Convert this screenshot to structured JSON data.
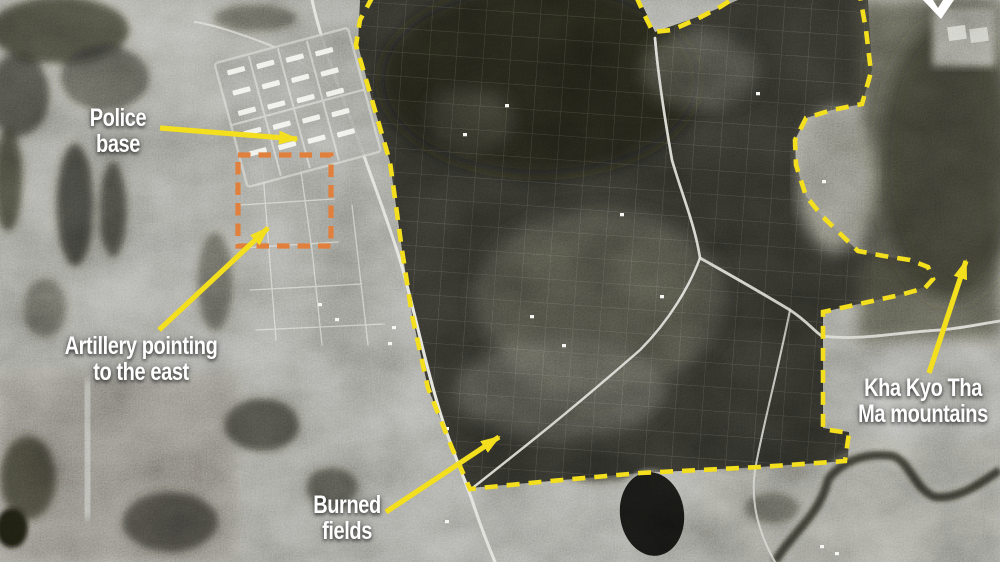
{
  "page": {
    "kind": "annotated black-and-white satellite image",
    "width_px": 1000,
    "height_px": 562
  },
  "annotations": {
    "colors": {
      "highlight_yellow": "#F3DF1D",
      "artillery_orange": "#E0803C",
      "label_text": "#FFFFFF"
    },
    "labels": {
      "police_base": {
        "line1": "Police",
        "line2": "base"
      },
      "artillery": {
        "line1": "Artillery pointing",
        "line2": "to the east"
      },
      "burned_fields": {
        "line1": "Burned",
        "line2": "fields"
      },
      "mountains": {
        "line1": "Kha Kyo Tha",
        "line2": "Ma mountains"
      }
    },
    "icons": [
      {
        "name": "north-star-icon",
        "shape": "white compass star clipped at top edge"
      }
    ],
    "shapes": [
      {
        "name": "burned-area-outline",
        "style": "yellow dashed outline around burned fields"
      },
      {
        "name": "burned-area-outline-secondary",
        "style": "yellow dashed arc at top edge"
      },
      {
        "name": "artillery-highlight-box",
        "style": "orange dashed rectangle over artillery positions"
      }
    ]
  }
}
